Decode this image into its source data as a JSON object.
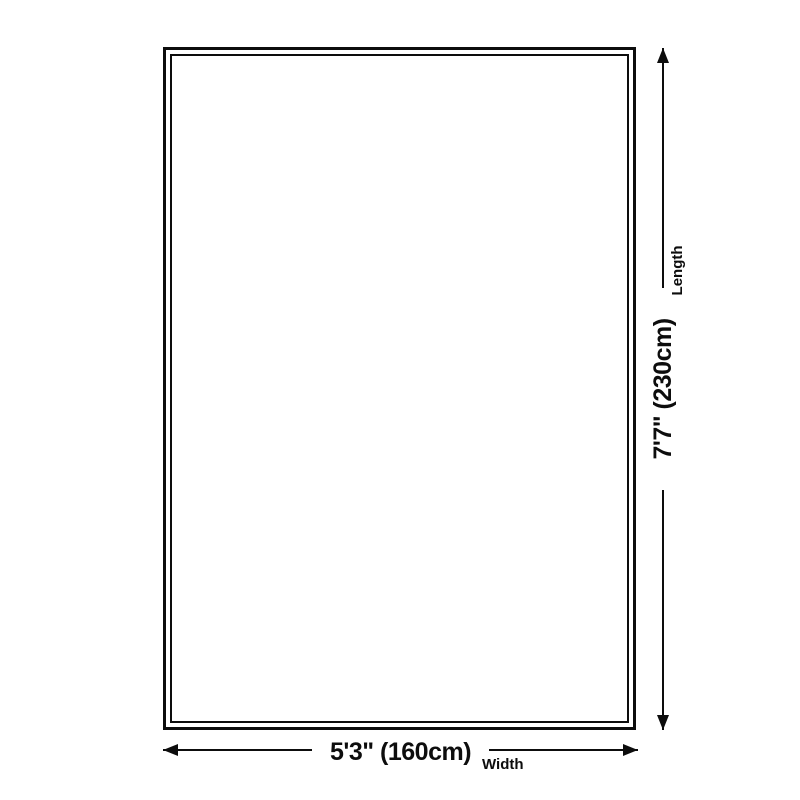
{
  "diagram": {
    "background_color": "#ffffff",
    "line_color": "#0d0d0d",
    "width": {
      "value": "5'3\" (160cm)",
      "caption": "Width"
    },
    "length": {
      "value": "7'7\" (230cm)",
      "caption": "Length"
    }
  }
}
